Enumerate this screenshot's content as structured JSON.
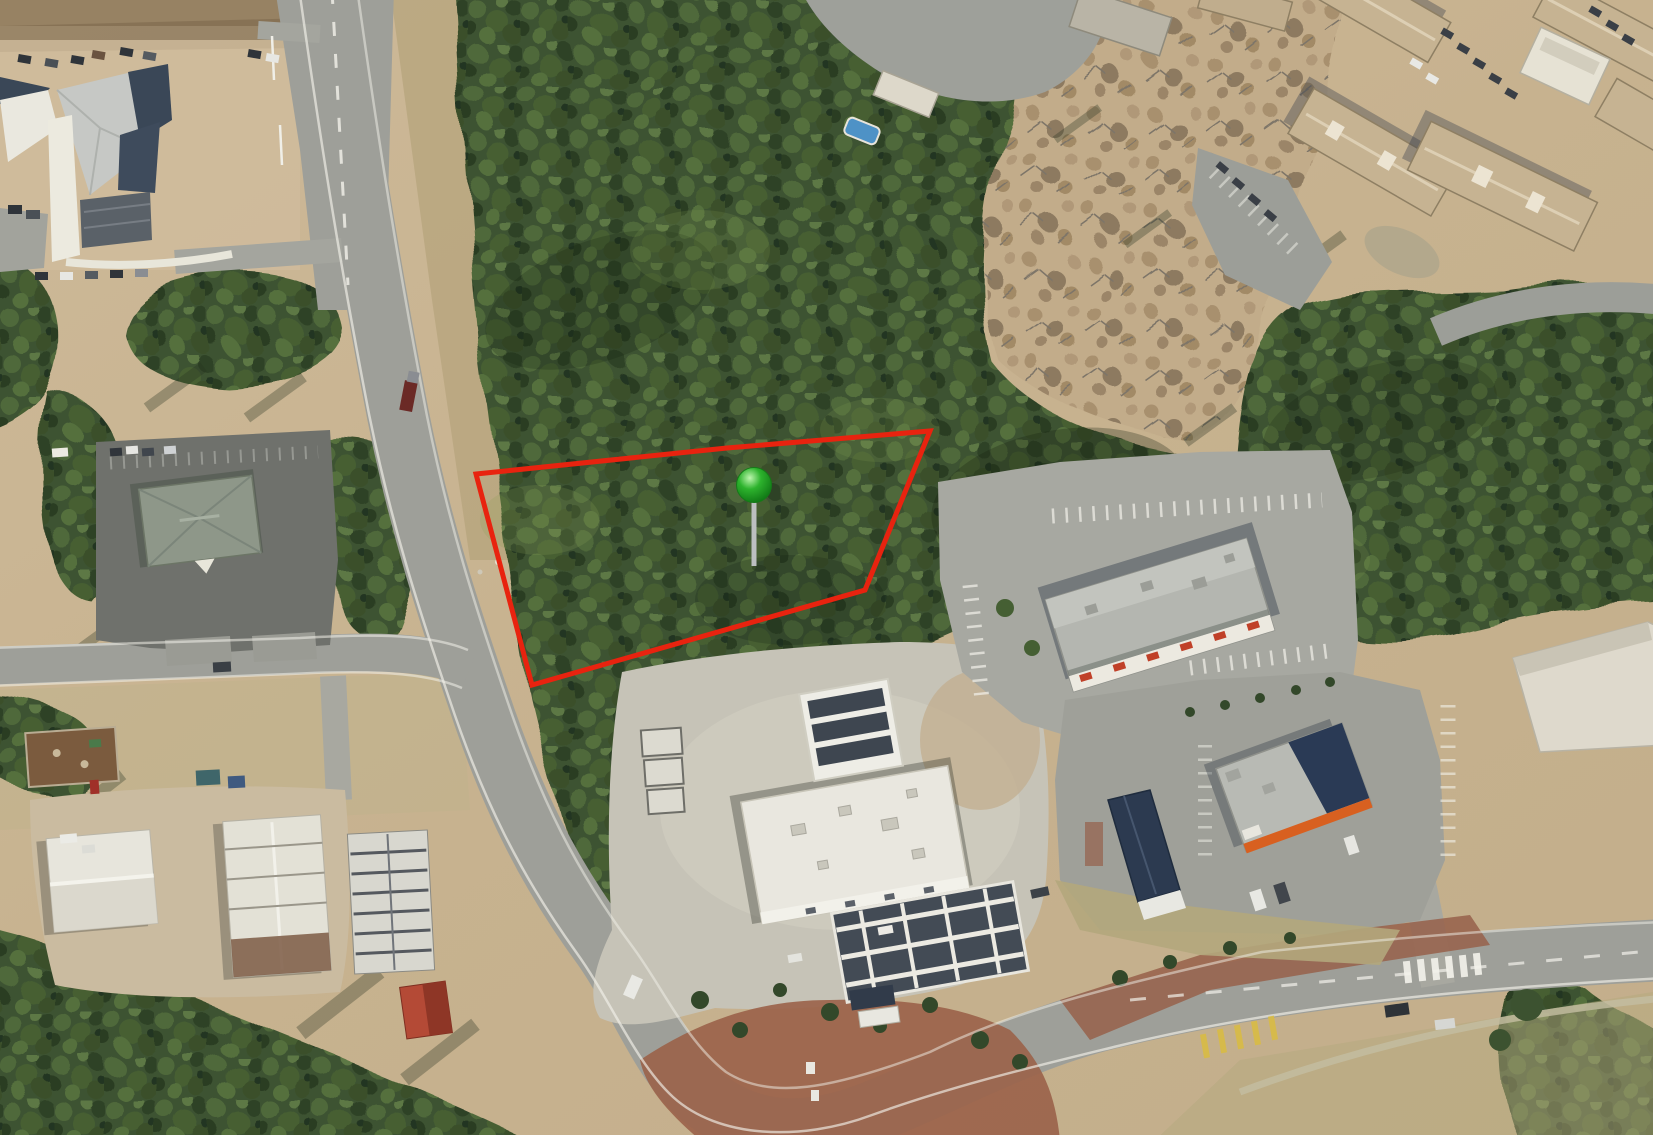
{
  "map": {
    "kind": "aerial-imagery-with-parcel-overlay"
  },
  "overlay": {
    "parcel_boundary": {
      "points": "476,474 727,448 930,431 865,590 532,685",
      "stroke_color": "#e8230f",
      "stroke_width": 5
    },
    "location_marker": {
      "x": 754,
      "y": 485,
      "radius": 17.5,
      "fill_color": "#2db32d",
      "highlight_color": "#bdf6ae",
      "shadow_color": "#0b6e11",
      "outline_color": "#157a18",
      "stem_top_y": 500,
      "stem_bottom_y": 566,
      "stem_color": "#bcbfc0",
      "stem_width": 5
    }
  },
  "palette": {
    "ground_tan": "#c9b493",
    "forest_green": "#46603a",
    "road_gray": "#9e9f99",
    "parcel_red": "#e8230f",
    "marker_green": "#2db32d"
  }
}
